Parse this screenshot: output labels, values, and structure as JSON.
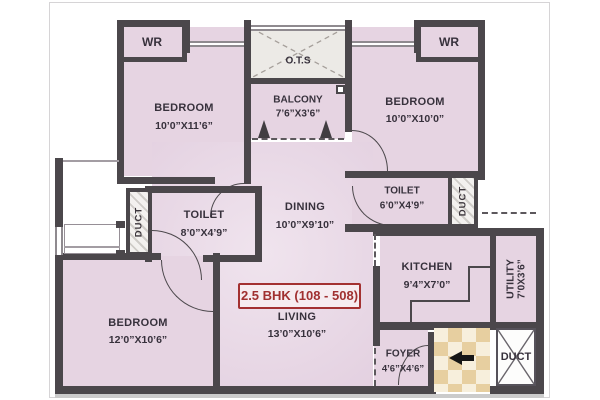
{
  "title_badge": "2.5 BHK (108 - 508)",
  "rooms": {
    "bedroom_top_left": {
      "name": "BEDROOM",
      "dims": "10’0”X11’6”"
    },
    "bedroom_top_right": {
      "name": "BEDROOM",
      "dims": "10’0”X10’0”"
    },
    "bedroom_bottom_left": {
      "name": "BEDROOM",
      "dims": "12’0”X10’6”"
    },
    "balcony": {
      "name": "BALCONY",
      "dims": "7’6”X3’6”"
    },
    "ots": {
      "name": "O.T.S"
    },
    "toilet_left": {
      "name": "TOILET",
      "dims": "8’0”X4’9”"
    },
    "toilet_right": {
      "name": "TOILET",
      "dims": "6’0”X4’9”"
    },
    "dining": {
      "name": "DINING",
      "dims": "10’0”X9’10”"
    },
    "living": {
      "name": "LIVING",
      "dims": "13’0”X10’6”"
    },
    "kitchen": {
      "name": "KITCHEN",
      "dims": "9’4”X7’0”"
    },
    "utility": {
      "name": "UTILITY",
      "dims": "7’0X3’6”"
    },
    "foyer": {
      "name": "FOYER",
      "dims": "4’6”X4’6”"
    }
  },
  "labels": {
    "wardrobe_left": "WR",
    "wardrobe_right": "WR",
    "duct_left": "DUCT",
    "duct_right": "DUCT",
    "duct_bottom": "DUCT"
  },
  "colors": {
    "wall": "#4b474b",
    "floor": "#e6d4e2",
    "accent_red": "#a33131",
    "checker_tan": "#e7cfa0",
    "hatch_gray": "#cfccc8"
  }
}
